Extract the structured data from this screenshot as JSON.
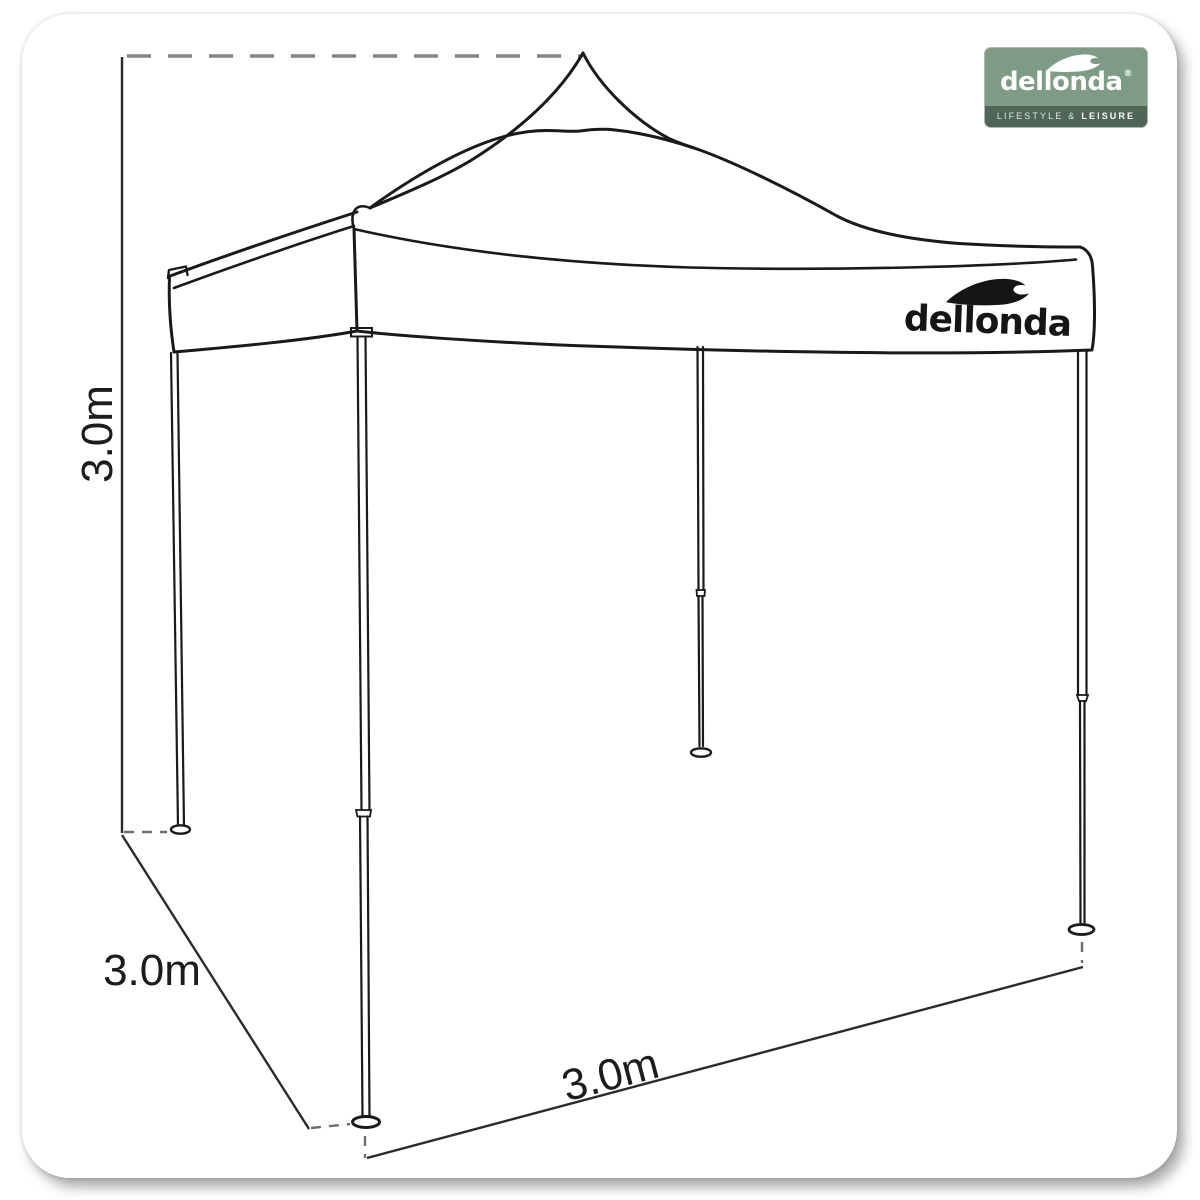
{
  "brand": {
    "name": "dellonda",
    "registered_mark": "®",
    "tagline": {
      "left": "LIFESTYLE",
      "amp": "&",
      "right": "LEISURE"
    },
    "icons": {
      "wave": "wave-icon"
    },
    "colors": {
      "logo_bg": "#7e9c85",
      "logo_band_bg": "#4e6557",
      "logo_text": "#ffffff"
    }
  },
  "canopy": {
    "logo_text": "dellonda"
  },
  "dimensions": {
    "height": {
      "label": "3.0m"
    },
    "depth": {
      "label": "3.0m"
    },
    "width": {
      "label": "3.0m"
    }
  },
  "style": {
    "outline_color": "#1a1a1a",
    "dimension_line_color": "#2b2b2b",
    "dash_color": "#848484",
    "label_color": "#1c1c1c"
  }
}
